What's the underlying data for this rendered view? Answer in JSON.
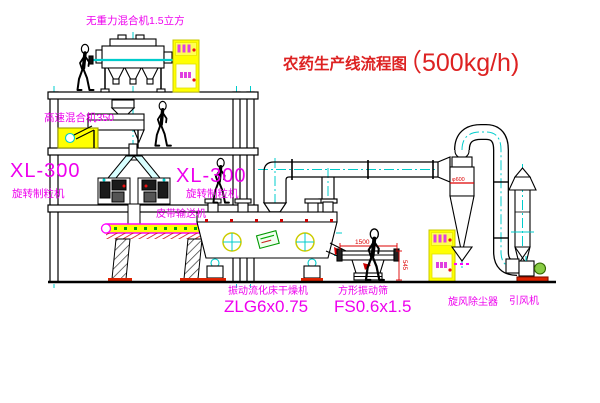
{
  "title": {
    "text": "农药生产线流程图",
    "capacity": "（500kg/h)"
  },
  "labels": {
    "gravity_mixer": "无重力混合机1.5立方",
    "high_speed_mixer": "高速混合机350",
    "granulator_model": "XL-300",
    "granulator_name": "旋转制粒机",
    "belt_conveyor": "皮带输送机",
    "dryer_name": "振动流化床干燥机",
    "dryer_model": "ZLG6x0.75",
    "screen_name": "方形振动筛",
    "screen_model": "FS0.6x1.5",
    "cyclone_name": "旋风除尘器",
    "fan_name": "引风机"
  },
  "dimensions": {
    "screen_length": "1500",
    "screen_height": "545",
    "cyclone_note": "φ600"
  },
  "colors": {
    "label_magenta": "#ee00ee",
    "title_red": "#dd2222",
    "dimension_red": "#dd0000",
    "centerline_cyan": "#00cccc",
    "cabinet_yellow": "#ffff00",
    "line_black": "#000000"
  }
}
